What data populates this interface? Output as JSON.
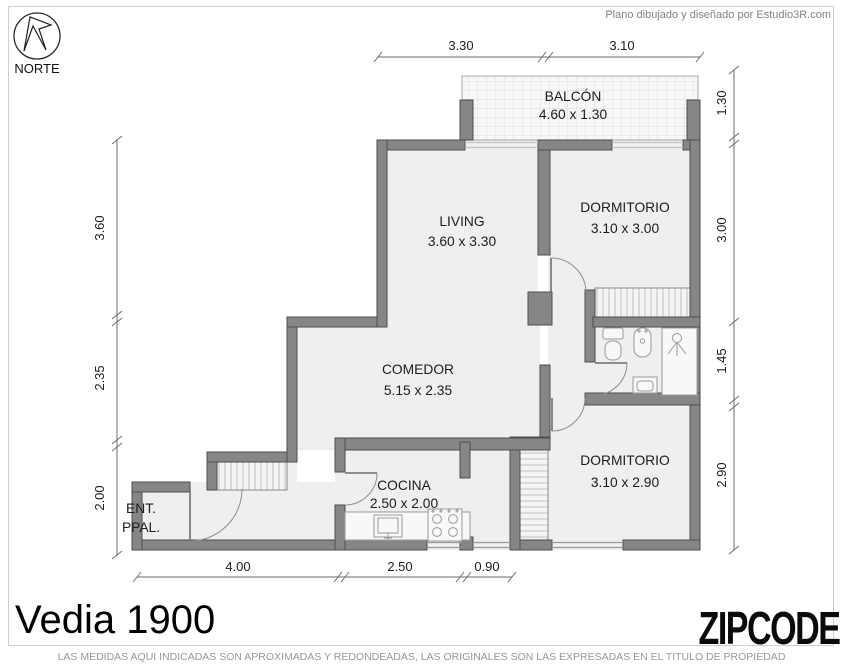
{
  "header": {
    "credit": "Plano dibujado y diseñado por Estudio3R.com"
  },
  "compass": {
    "label": "NORTE"
  },
  "rooms": [
    {
      "line1": "BALCÓN",
      "line2": "4.60 x 1.30"
    },
    {
      "line1": "LIVING",
      "line2": "3.60 x 3.30"
    },
    {
      "line1": "DORMITORIO",
      "line2": "3.10 x 3.00"
    },
    {
      "line1": "COMEDOR",
      "line2": "5.15 x 2.35"
    },
    {
      "line1": "COCINA",
      "line2": "2.50 x 2.00"
    },
    {
      "line1": "DORMITORIO",
      "line2": "3.10 x 2.90"
    },
    {
      "line1": "ENT.",
      "line2": "PPAL."
    }
  ],
  "dimensions": {
    "top": [
      "3.30",
      "3.10"
    ],
    "right": [
      "1.30",
      "3.00",
      "1.45",
      "2.90"
    ],
    "left": [
      "3.60",
      "2.35",
      "2.00"
    ],
    "bottom": [
      "4.00",
      "2.50",
      "0.90"
    ]
  },
  "footer": {
    "title": "Vedia 1900",
    "logo": "ZIPCODE",
    "disclaimer": "LAS MEDIDAS AQUI INDICADAS SON APROXIMADAS Y REDONDEADAS, LAS ORIGINALES SON LAS EXPRESADAS EN EL TITULO DE PROPIEDAD"
  },
  "colors": {
    "wall": "#868686",
    "floor": "#efefef",
    "hatch": "#bfbfbf",
    "dimension_line": "#6b6b6b",
    "text": "#1c1c1c",
    "muted_text": "#979797"
  }
}
